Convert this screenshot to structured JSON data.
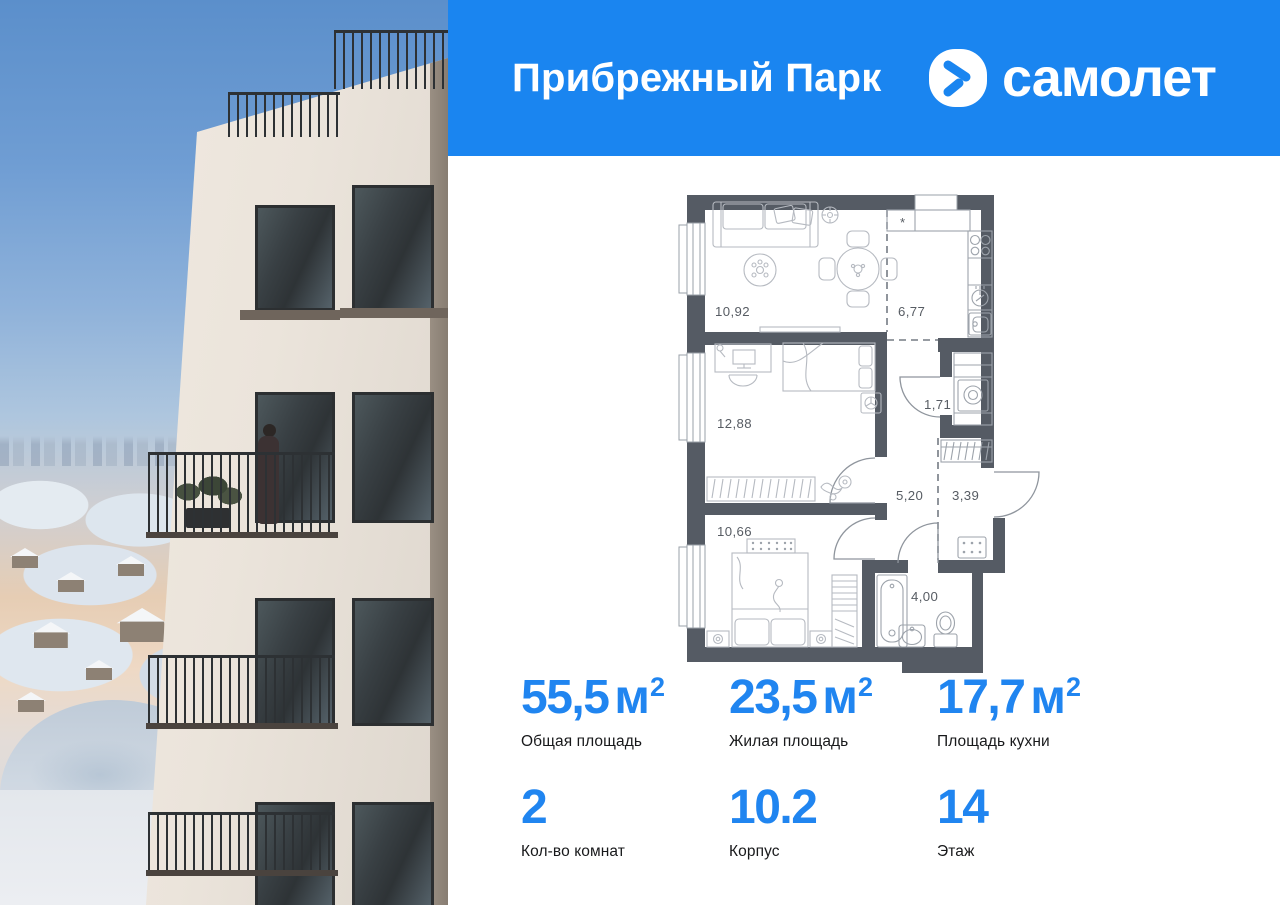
{
  "header": {
    "project_name": "Прибрежный Парк",
    "brand_name": "самолет"
  },
  "floor_plan": {
    "vent_symbol": "*",
    "rooms": [
      {
        "name": "living-room",
        "area": "10,92"
      },
      {
        "name": "kitchen",
        "area": "6,77"
      },
      {
        "name": "bedroom-1",
        "area": "12,88"
      },
      {
        "name": "laundry-closet",
        "area": "1,71"
      },
      {
        "name": "hallway",
        "area": "5,20"
      },
      {
        "name": "entry-hall",
        "area": "3,39"
      },
      {
        "name": "bedroom-2",
        "area": "10,66"
      },
      {
        "name": "bathroom",
        "area": "4,00"
      }
    ]
  },
  "stats": {
    "row1": [
      {
        "value": "55,5",
        "unit": "м",
        "sup": "2",
        "label": "Общая площадь"
      },
      {
        "value": "23,5",
        "unit": "м",
        "sup": "2",
        "label": "Жилая площадь"
      },
      {
        "value": "17,7",
        "unit": "м",
        "sup": "2",
        "label": "Площадь кухни"
      }
    ],
    "row2": [
      {
        "value": "2",
        "label": "Кол-во комнат"
      },
      {
        "value": "10.2",
        "label": "Корпус"
      },
      {
        "value": "14",
        "label": "Этаж"
      }
    ]
  },
  "colors": {
    "header_blue": "#1a85f0",
    "stat_blue": "#2085f0",
    "wall_gray": "#555b64"
  }
}
